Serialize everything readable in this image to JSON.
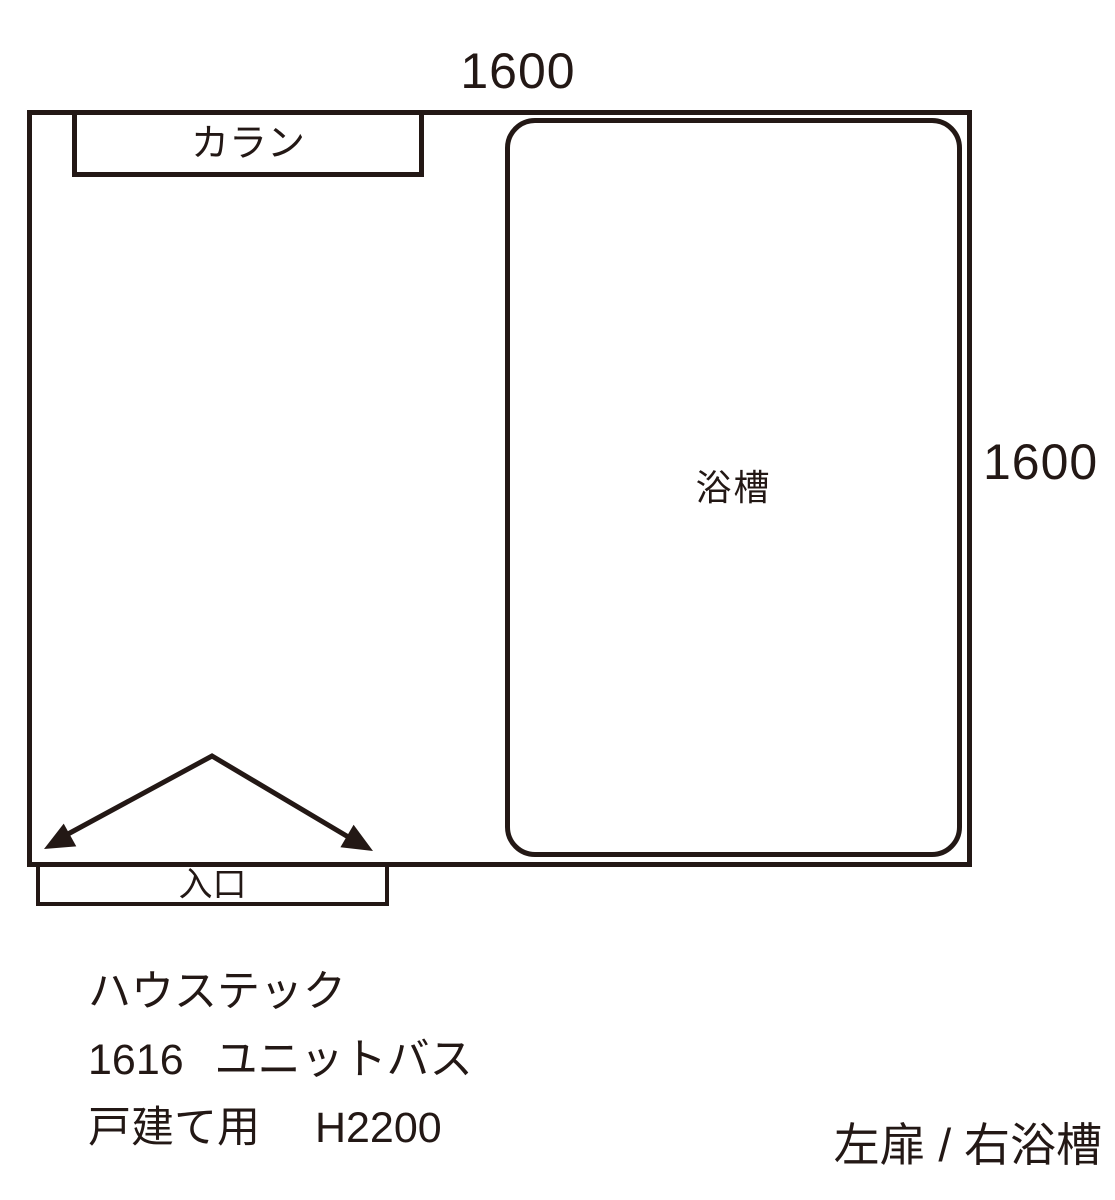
{
  "meta": {
    "line_color": "#231815",
    "bg_color": "#ffffff"
  },
  "dimensions": {
    "top": "1600",
    "right": "1600"
  },
  "plan": {
    "faucet_label": "カラン",
    "bathtub_label": "浴槽",
    "entrance_label": "入口"
  },
  "notes": {
    "line1": "ハウステック",
    "line2": "1616 ユニットバス",
    "line3": "戸建て用 H2200"
  },
  "caption": "左扉 / 右浴槽"
}
